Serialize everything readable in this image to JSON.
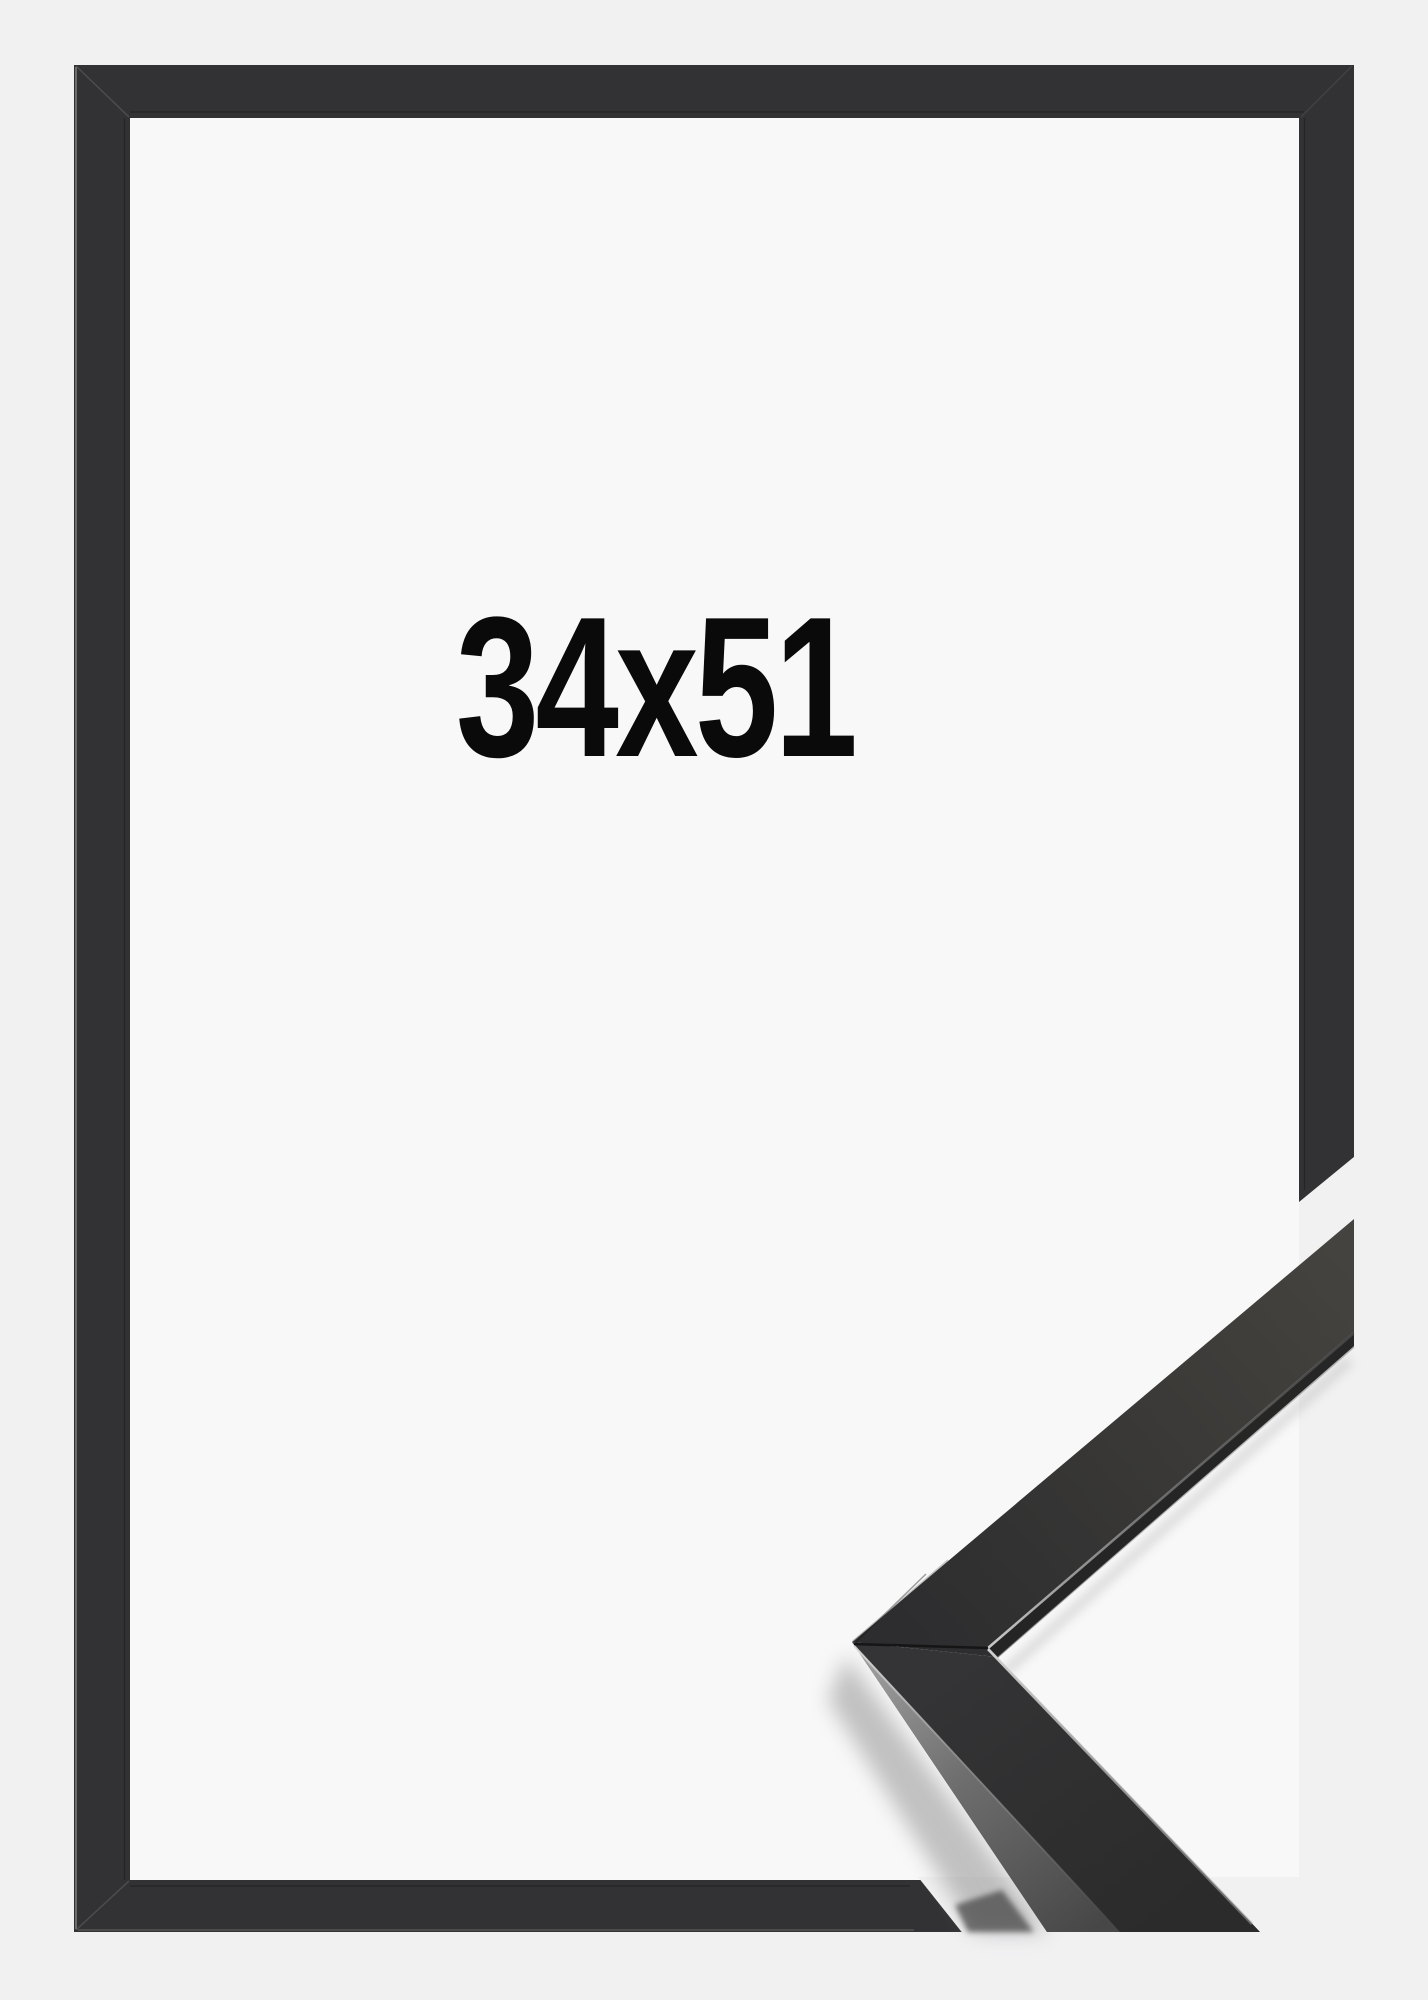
{
  "product": {
    "size_label": "34x51"
  },
  "palette": {
    "background": "#f1f1f2",
    "frame_interior": "#f8f8f9",
    "frame_moulding": "#323234",
    "sample_top_face_near": "#2d2d2f",
    "sample_top_face_far": "#45433f",
    "sample_side_face_light": "#a2a2a2",
    "sample_side_face_dark": "#474747",
    "label_text": "#0a0a0a"
  }
}
